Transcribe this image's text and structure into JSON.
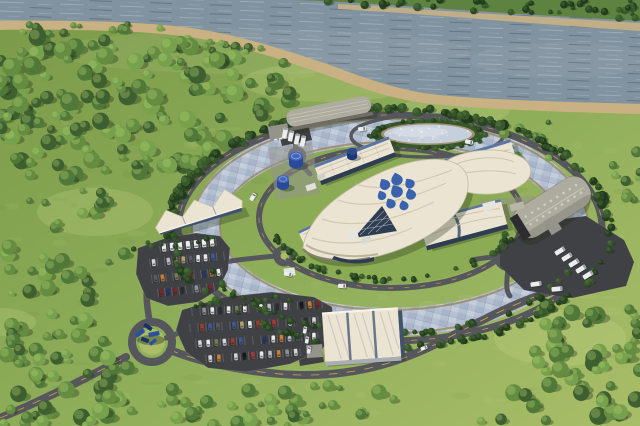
{
  "palette": {
    "river": "#8193a0",
    "far_bank_grass": "#5e8340",
    "sand": "#c9b183",
    "sand_dark": "#9a8258",
    "grass_a": "#7b9a49",
    "grass_b": "#8fae5a",
    "grass_c": "#a9bd68",
    "campus_grass": "#8cab55",
    "meadow_light": "#d9e398",
    "forest1": "#3e6030",
    "forest2": "#4f7839",
    "forest3": "#648d42",
    "forest4": "#78a14d",
    "hedge1": "#2a4723",
    "hedge2": "#37572c",
    "hedge3": "#223c1e",
    "road": "#56575c",
    "asphalt": "#404145",
    "yellow_line": "#c9a94e",
    "channel": "#b5c1d2",
    "channel_hi": "#ced7e3",
    "channel_lo": "#9caabf",
    "concrete": "#94938c",
    "roof_cream": "#ebe4d3",
    "roof_rib": "#cfc5ae",
    "fascia": "#f8f4ea",
    "roof_band": "#5b76a4",
    "roof_grey": "#aeab9f",
    "warehouse_face": "#6f6d64",
    "glass": "#41526b",
    "glass_dark": "#2e3d52",
    "panel_seam": "#69768b",
    "panel_edge": "#a8adb6",
    "pond_fill": "#c6cfdc",
    "pond_rim": "#a3926f",
    "tank_blue": "#29499a",
    "tank_blue_top": "#4466b8",
    "tank_navy": "#1c3878",
    "logo_blue": "#3a62ad",
    "sculpture_a": "#2a509f",
    "sculpture_b": "#173069",
    "vehicle_white": "#eceded",
    "vehicle_grey": "#9aa0a6",
    "car_colors": [
      "#e9e9e7",
      "#e9e9e7",
      "#d4d5d6",
      "#babcc0",
      "#8f9296",
      "#595b60",
      "#2c2d31",
      "#17181c",
      "#a63732",
      "#7c2726",
      "#3c5c97",
      "#24386b",
      "#b5a26b",
      "#757d52",
      "#c87f33"
    ]
  },
  "scene": {
    "tree_regions": [
      {
        "name": "far-bank-trees",
        "layer": "farbank",
        "type": "poly",
        "pts": [
          [
            300,
            0
          ],
          [
            640,
            0
          ],
          [
            640,
            20
          ],
          [
            540,
            16
          ],
          [
            430,
            10
          ],
          [
            340,
            4
          ]
        ],
        "count": 42,
        "rmin": 2,
        "rmax": 4.5,
        "dark": true
      },
      {
        "name": "riverbank-trees",
        "type": "poly",
        "pts": [
          [
            0,
            24
          ],
          [
            140,
            24
          ],
          [
            230,
            38
          ],
          [
            300,
            58
          ],
          [
            310,
            70
          ],
          [
            250,
            60
          ],
          [
            150,
            40
          ],
          [
            0,
            32
          ]
        ],
        "count": 26,
        "rmin": 2.5,
        "rmax": 5.5,
        "dark": false
      },
      {
        "name": "northwest-forest",
        "type": "poly",
        "pts": [
          [
            0,
            34
          ],
          [
            120,
            36
          ],
          [
            200,
            44
          ],
          [
            262,
            60
          ],
          [
            294,
            78
          ],
          [
            296,
            102
          ],
          [
            266,
            134
          ],
          [
            224,
            156
          ],
          [
            172,
            172
          ],
          [
            112,
            184
          ],
          [
            52,
            178
          ],
          [
            0,
            158
          ]
        ],
        "count": 150,
        "rmin": 4,
        "rmax": 9.5,
        "dark": false
      },
      {
        "name": "left-edge-trees",
        "type": "poly",
        "pts": [
          [
            0,
            160
          ],
          [
            60,
            172
          ],
          [
            110,
            192
          ],
          [
            132,
            230
          ],
          [
            126,
            300
          ],
          [
            92,
            330
          ],
          [
            0,
            330
          ]
        ],
        "count": 42,
        "rmin": 3,
        "rmax": 8,
        "dark": false
      },
      {
        "name": "bottom-left-forest",
        "type": "poly",
        "pts": [
          [
            0,
            330
          ],
          [
            110,
            332
          ],
          [
            150,
            378
          ],
          [
            128,
            426
          ],
          [
            0,
            426
          ]
        ],
        "count": 50,
        "rmin": 4,
        "rmax": 9,
        "dark": false
      },
      {
        "name": "bottom-center-trees",
        "type": "poly",
        "pts": [
          [
            150,
            380
          ],
          [
            320,
            384
          ],
          [
            430,
            398
          ],
          [
            330,
            426
          ],
          [
            140,
            426
          ]
        ],
        "count": 36,
        "rmin": 3,
        "rmax": 8,
        "dark": false
      },
      {
        "name": "bottom-right-forest",
        "type": "poly",
        "pts": [
          [
            545,
            302
          ],
          [
            640,
            308
          ],
          [
            640,
            426
          ],
          [
            470,
            426
          ],
          [
            520,
            360
          ]
        ],
        "count": 55,
        "rmin": 4,
        "rmax": 9,
        "dark": false
      },
      {
        "name": "northeast-trees",
        "type": "poly",
        "pts": [
          [
            498,
            118
          ],
          [
            552,
            122
          ],
          [
            556,
            158
          ],
          [
            504,
            160
          ]
        ],
        "count": 12,
        "rmin": 2.5,
        "rmax": 5.5,
        "dark": false
      },
      {
        "name": "east-edge-trees",
        "type": "poly",
        "pts": [
          [
            610,
            148
          ],
          [
            640,
            152
          ],
          [
            640,
            210
          ],
          [
            614,
            204
          ]
        ],
        "count": 9,
        "rmin": 2.5,
        "rmax": 5.5,
        "dark": false
      },
      {
        "name": "perimeter-tree-ring",
        "type": "band",
        "cx": 390,
        "cy": 228,
        "rx": 220,
        "ry": 119,
        "a0": 0,
        "a1": 360,
        "count": 150,
        "rmin": 2,
        "rmax": 4.5,
        "dark": true
      },
      {
        "name": "perimeter-tree-ring-top",
        "type": "band",
        "cx": 390,
        "cy": 228,
        "rx": 220,
        "ry": 119,
        "a0": 185,
        "a1": 355,
        "count": 80,
        "rmin": 2.5,
        "rmax": 5.5,
        "dark": true
      },
      {
        "name": "channel-outer-hedge",
        "type": "band",
        "cx": 390,
        "cy": 226,
        "rx": 199,
        "ry": 108,
        "a0": 25,
        "a1": 155,
        "count": 55,
        "rmin": 2,
        "rmax": 3.8,
        "dark": true
      },
      {
        "name": "channel-inner-hedge",
        "type": "band",
        "cx": 391,
        "cy": 218,
        "rx": 122,
        "ry": 62,
        "a0": 15,
        "a1": 165,
        "count": 50,
        "rmin": 2,
        "rmax": 3.6,
        "dark": true
      },
      {
        "name": "pond-hedge",
        "type": "band",
        "cx": 428,
        "cy": 134,
        "rx": 56,
        "ry": 14,
        "a0": 0,
        "a1": 360,
        "count": 44,
        "rmin": 1.8,
        "rmax": 3,
        "dark": true
      },
      {
        "name": "south-lot-hedge",
        "type": "poly",
        "pts": [
          [
            176,
            302
          ],
          [
            334,
            292
          ],
          [
            336,
            299
          ],
          [
            178,
            310
          ]
        ],
        "count": 13,
        "rmin": 1.8,
        "rmax": 3,
        "dark": true
      },
      {
        "name": "west-lot-hedge",
        "type": "poly",
        "pts": [
          [
            132,
            244
          ],
          [
            228,
            234
          ],
          [
            230,
            240
          ],
          [
            134,
            251
          ]
        ],
        "count": 10,
        "rmin": 1.8,
        "rmax": 3,
        "dark": true
      },
      {
        "name": "east-yard-hedge",
        "type": "poly",
        "pts": [
          [
            497,
            238
          ],
          [
            540,
            218
          ],
          [
            548,
            226
          ],
          [
            504,
            248
          ]
        ],
        "count": 8,
        "rmin": 2,
        "rmax": 4,
        "dark": true
      }
    ],
    "parking_lots": [
      {
        "name": "west",
        "pts": [
          [
            138,
            248
          ],
          [
            166,
            238
          ],
          [
            196,
            233
          ],
          [
            220,
            236
          ],
          [
            230,
            248
          ],
          [
            228,
            270
          ],
          [
            218,
            290
          ],
          [
            198,
            302
          ],
          [
            168,
            306
          ],
          [
            146,
            298
          ],
          [
            136,
            274
          ]
        ],
        "rows": [
          [
            160,
            248,
            216,
            242,
            7,
            "van"
          ],
          [
            150,
            263,
            224,
            256,
            10
          ],
          [
            152,
            279,
            222,
            272,
            10
          ],
          [
            158,
            293,
            214,
            287,
            8
          ]
        ]
      },
      {
        "name": "south",
        "pts": [
          [
            182,
            310
          ],
          [
            224,
            297
          ],
          [
            272,
            292
          ],
          [
            314,
            297
          ],
          [
            332,
            307
          ],
          [
            334,
            330
          ],
          [
            322,
            350
          ],
          [
            290,
            364
          ],
          [
            246,
            372
          ],
          [
            208,
            368
          ],
          [
            186,
            352
          ],
          [
            176,
            330
          ]
        ],
        "rows": [
          [
            192,
            312,
            322,
            304,
            16
          ],
          [
            190,
            328,
            326,
            320,
            17
          ],
          [
            196,
            344,
            318,
            336,
            15
          ],
          [
            206,
            359,
            300,
            352,
            11
          ]
        ]
      }
    ],
    "vehicles": [
      [
        253,
        197,
        -58,
        "van"
      ],
      [
        342,
        286,
        4,
        "van"
      ],
      [
        424,
        348,
        -22,
        "car_white"
      ],
      [
        362,
        129,
        -6,
        "van"
      ],
      [
        469,
        142,
        10,
        "van"
      ],
      [
        536,
        284,
        -8,
        "truck"
      ],
      [
        557,
        289,
        -6,
        "truck"
      ],
      [
        560,
        251,
        -32,
        "truck"
      ],
      [
        567,
        257,
        -32,
        "truck"
      ],
      [
        574,
        263,
        -32,
        "truck"
      ],
      [
        581,
        269,
        -32,
        "truck"
      ],
      [
        588,
        275,
        -32,
        "truck"
      ],
      [
        285,
        133,
        -78,
        "truck"
      ],
      [
        291,
        136,
        -78,
        "truck"
      ],
      [
        297,
        139,
        -78,
        "truck"
      ],
      [
        303,
        141,
        -78,
        "truck"
      ],
      [
        305,
        330,
        -80,
        "car_white"
      ],
      [
        307,
        340,
        -80,
        "car_white"
      ],
      [
        309,
        350,
        -80,
        "car_white"
      ],
      [
        288,
        274,
        12,
        "van"
      ]
    ],
    "pond": {
      "cx": 428,
      "cy": 134,
      "rx": 44,
      "ry": 9.5,
      "sparkles": 28
    },
    "sculpture": {
      "x": 149,
      "y": 336,
      "pieces": [
        [
          -9,
          -3,
          10,
          4.5,
          -35,
          0
        ],
        [
          -1,
          -9,
          9,
          4,
          35,
          1
        ],
        [
          5,
          -2,
          11,
          4.5,
          -12,
          0
        ],
        [
          -4,
          4,
          8,
          4,
          20,
          1
        ],
        [
          4,
          6,
          8,
          3.5,
          -40,
          0
        ]
      ]
    },
    "logo": {
      "x": 399,
      "y": 193,
      "drops": [
        [
          -14,
          -8,
          1.1,
          -30
        ],
        [
          -2,
          -13,
          1.2,
          -15
        ],
        [
          11,
          -9,
          1.0,
          -35
        ],
        [
          -17,
          3,
          0.9,
          -25
        ],
        [
          -2,
          -1,
          1.25,
          -30
        ],
        [
          12,
          2,
          1.05,
          -20
        ],
        [
          -8,
          11,
          1.0,
          -30
        ],
        [
          5,
          13,
          0.95,
          -18
        ]
      ]
    },
    "skylights": {
      "x": 586,
      "y": 186,
      "rot": 58,
      "cols": [
        -6,
        3
      ],
      "y0": 8,
      "step": 7.4,
      "n": 9,
      "r": 1.3
    }
  }
}
